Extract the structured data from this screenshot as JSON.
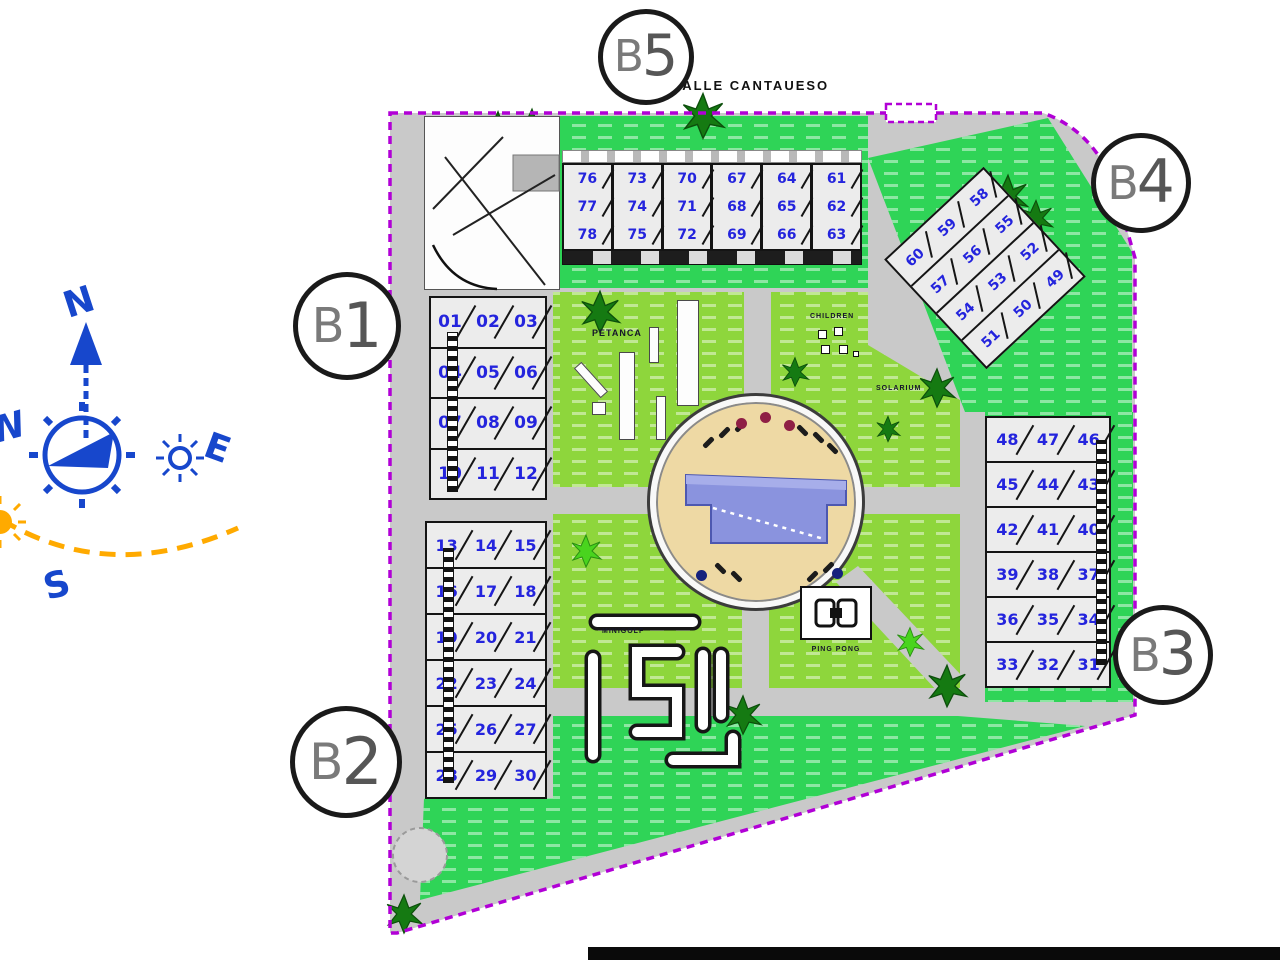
{
  "street_label": "CALLE CANTAUESO",
  "markers": {
    "b1": {
      "prefix": "B",
      "digit": "1"
    },
    "b2": {
      "prefix": "B",
      "digit": "2"
    },
    "b3": {
      "prefix": "B",
      "digit": "3"
    },
    "b4": {
      "prefix": "B",
      "digit": "4"
    },
    "b5": {
      "prefix": "B",
      "digit": "5"
    }
  },
  "compass": {
    "north": "N",
    "east": "E",
    "south": "S",
    "west": "W"
  },
  "area_labels": {
    "petanca": "PETANCA",
    "children": "CHILDREN",
    "solarium": "SOLARIUM",
    "minigolf": "MINIGOLF",
    "ping_pong": "PING PONG"
  },
  "blocks": {
    "top": {
      "rows": [
        [
          "76",
          "73",
          "70",
          "67",
          "64",
          "61"
        ],
        [
          "77",
          "74",
          "71",
          "68",
          "65",
          "62"
        ],
        [
          "78",
          "75",
          "72",
          "69",
          "66",
          "63"
        ]
      ]
    },
    "left_upper": {
      "rows": [
        [
          "01",
          "02",
          "03"
        ],
        [
          "04",
          "05",
          "06"
        ],
        [
          "07",
          "08",
          "09"
        ],
        [
          "10",
          "11",
          "12"
        ]
      ]
    },
    "left_lower": {
      "rows": [
        [
          "13",
          "14",
          "15"
        ],
        [
          "16",
          "17",
          "18"
        ],
        [
          "19",
          "20",
          "21"
        ],
        [
          "22",
          "23",
          "24"
        ],
        [
          "25",
          "26",
          "27"
        ],
        [
          "28",
          "29",
          "30"
        ]
      ]
    },
    "diagonal": {
      "rows": [
        [
          "60",
          "59",
          "58"
        ],
        [
          "57",
          "56",
          "55"
        ],
        [
          "54",
          "53",
          "52"
        ],
        [
          "51",
          "50",
          "49"
        ]
      ]
    },
    "right": {
      "rows": [
        [
          "48",
          "47",
          "46"
        ],
        [
          "45",
          "44",
          "43"
        ],
        [
          "42",
          "41",
          "40"
        ],
        [
          "39",
          "38",
          "37"
        ],
        [
          "36",
          "35",
          "34"
        ],
        [
          "33",
          "32",
          "31"
        ]
      ]
    }
  },
  "colors": {
    "boundary": "#b100d6",
    "lawn_bright": "#2fd457",
    "lawn_yellow": "#8ed63c",
    "road": "#c9c9c9",
    "sand": "#eed9a4",
    "pool": "#8a93de",
    "unit_number": "#2424dd",
    "compass_blue": "#1747cc",
    "sun_orange": "#ffaa00"
  }
}
